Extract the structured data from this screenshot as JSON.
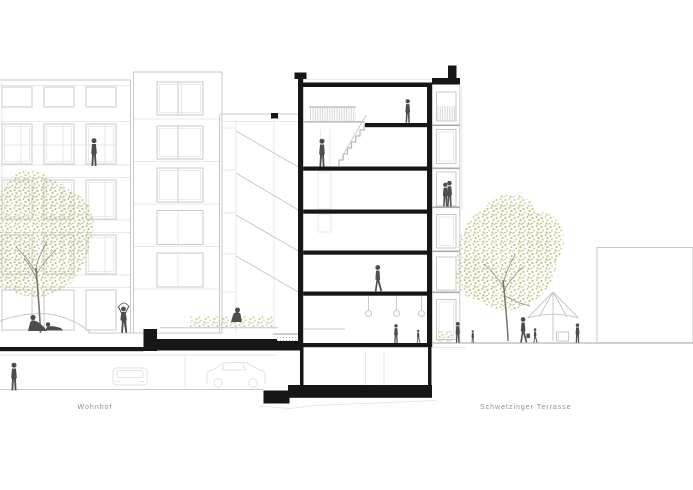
{
  "title": "Architectural cross-section drawing",
  "labels": {
    "left": "Wohnhof",
    "right": "Schwetzinger Terrasse"
  },
  "colors": {
    "paper": "#ffffff",
    "ink": "#161616",
    "figure": "#4d4d4d",
    "line": "#c9c9c9",
    "line-strong": "#a8a8a8",
    "line-soft": "#e2e2e2",
    "foliage": "#c3c47b",
    "foliage2": "#cfd09a",
    "speckle": "#b4b4a6",
    "trunk": "#7c7468",
    "label": "#8f8f8f"
  },
  "scene": {
    "buildings": [
      {
        "name": "left residential building",
        "render": "light elevation with window grid, rear volume and front wing"
      },
      {
        "name": "sectioned apartment building",
        "render": "black cut walls and floor slabs, 6 levels plus basement, roof terrace parapets, street-side bay with balconies"
      },
      {
        "name": "right neighbouring building",
        "render": "plain outline block"
      }
    ],
    "levels": [
      "roof",
      "floor 4 with stair void and railing",
      "floor 3",
      "floor 2",
      "floor 1",
      "ground floor with pendant lamps",
      "basement / underground garage"
    ],
    "people": [
      {
        "where": "left facade loggia",
        "pose": "standing"
      },
      {
        "where": "courtyard mound",
        "pose": "two reclining"
      },
      {
        "where": "courtyard",
        "pose": "skipping rope"
      },
      {
        "where": "underground garage",
        "pose": "standing"
      },
      {
        "where": "courtyard planting",
        "pose": "crouching gardener"
      },
      {
        "where": "section floor 3",
        "pose": "standing"
      },
      {
        "where": "section top floor",
        "pose": "standing"
      },
      {
        "where": "section floor 1",
        "pose": "walking"
      },
      {
        "where": "section ground floor",
        "pose": "adult and child"
      },
      {
        "where": "bay balcony",
        "pose": "embracing couple"
      },
      {
        "where": "right terrace",
        "pose": "adult with child, walking woman with bag and child, standing man"
      }
    ],
    "vehicles": [
      {
        "type": "car side view",
        "where": "underground garage"
      },
      {
        "type": "car front view",
        "where": "underground garage"
      }
    ],
    "vegetation": [
      {
        "type": "tree",
        "where": "left courtyard"
      },
      {
        "type": "tree",
        "where": "right terrace"
      },
      {
        "type": "planting bed",
        "where": "courtyard deck"
      },
      {
        "type": "shrub",
        "where": "right terrace edge"
      }
    ],
    "furniture": [
      {
        "type": "parasol",
        "where": "right terrace"
      },
      {
        "type": "table",
        "where": "right terrace"
      }
    ]
  }
}
